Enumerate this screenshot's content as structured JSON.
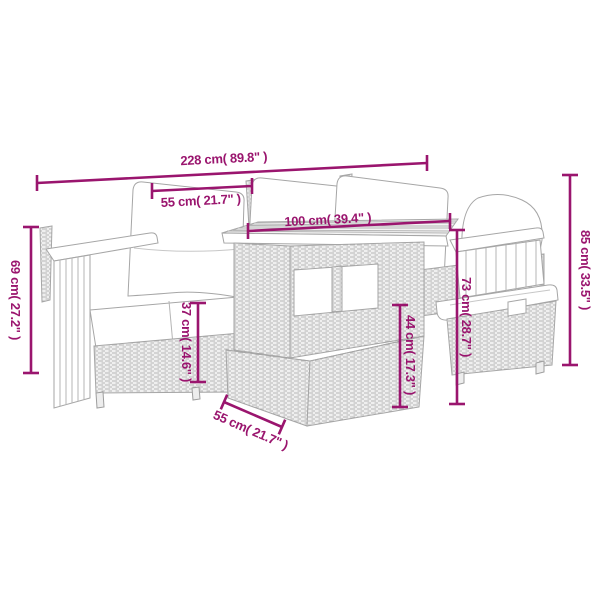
{
  "accent_color": "#9A156E",
  "artwork_color": "#a6a6a6",
  "background_color": "#ffffff",
  "dimensions": {
    "total_width": {
      "label": "228 cm( 89.8\" )",
      "cm": 228,
      "inch": 89.8
    },
    "cushion_width": {
      "label": "55 cm( 21.7\" )",
      "cm": 55,
      "inch": 21.7
    },
    "table_length": {
      "label": "100 cm( 39.4\" )",
      "cm": 100,
      "inch": 39.4
    },
    "total_height": {
      "label": "85 cm( 33.5\" )",
      "cm": 85,
      "inch": 33.5
    },
    "back_height": {
      "label": "73 cm( 28.7\" )",
      "cm": 73,
      "inch": 28.7
    },
    "table_height": {
      "label": "44 cm( 17.3\" )",
      "cm": 44,
      "inch": 17.3
    },
    "seat_height": {
      "label": "37 cm( 14.6\" )",
      "cm": 37,
      "inch": 14.6
    },
    "arm_height": {
      "label": "69 cm( 27.2\" )",
      "cm": 69,
      "inch": 27.2
    },
    "table_depth": {
      "label": "55 cm( 21.7\" )",
      "cm": 55,
      "inch": 21.7
    }
  }
}
